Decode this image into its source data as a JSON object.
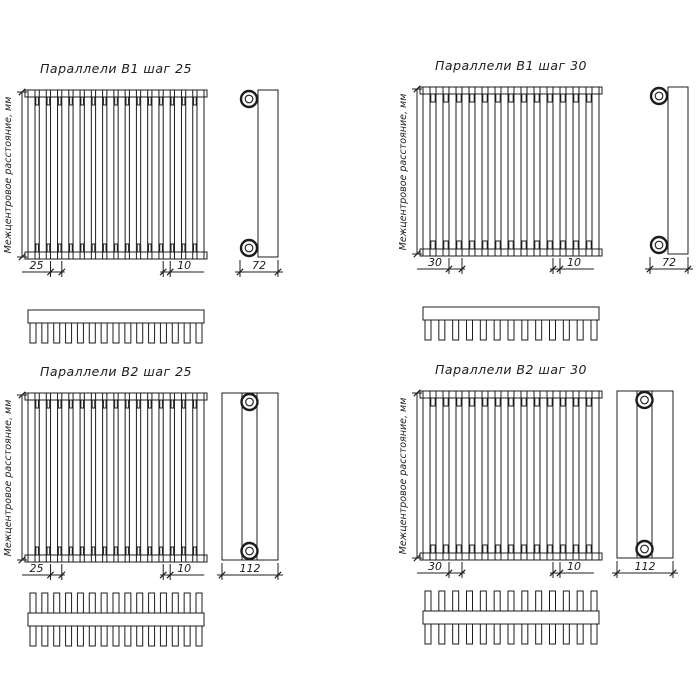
{
  "page": {
    "background": "#ffffff",
    "ink": "#1c1c1c"
  },
  "shared": {
    "vertical_axis_label": "Межцентровое расстояние, мм"
  },
  "diagrams": [
    {
      "title": "Параллели В1 шаг 25",
      "variant": "B1",
      "tubes": 16,
      "teeth": 15,
      "dims": {
        "step": "25",
        "tube": "10",
        "depth": "72"
      }
    },
    {
      "title": "Параллели В1 шаг 30",
      "variant": "B1",
      "tubes": 14,
      "teeth": 13,
      "dims": {
        "step": "30",
        "tube": "10",
        "depth": "72"
      }
    },
    {
      "title": "Параллели В2 шаг 25",
      "variant": "B2",
      "tubes": 16,
      "teeth": 15,
      "dims": {
        "step": "25",
        "tube": "10",
        "depth": "112"
      }
    },
    {
      "title": "Параллели В2 шаг 30",
      "variant": "B2",
      "tubes": 14,
      "teeth": 13,
      "dims": {
        "step": "30",
        "tube": "10",
        "depth": "112"
      }
    }
  ]
}
